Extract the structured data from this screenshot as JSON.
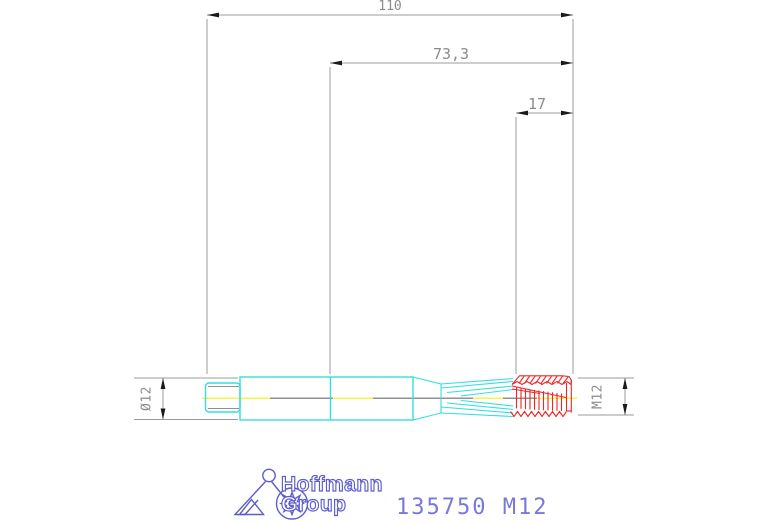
{
  "dimensions": {
    "overall_length": "110",
    "length_to_neck": "73,3",
    "thread_length": "17",
    "shank_diameter": "Ø12",
    "thread_size": "M12"
  },
  "footer": {
    "brand_line1": "Hoffmann",
    "brand_line2": "Group",
    "part_number": "135750 M12"
  },
  "colors": {
    "tool_body_cyan": "#35dede",
    "thread_red": "#ee2525",
    "centerline_yellow": "#f2f20a",
    "centerline_gray": "#6e6e6e",
    "dimension_gray": "#999999",
    "arrow_black": "#1a1a1a",
    "brand_blue": "#5c5cd0",
    "background": "#ffffff"
  }
}
